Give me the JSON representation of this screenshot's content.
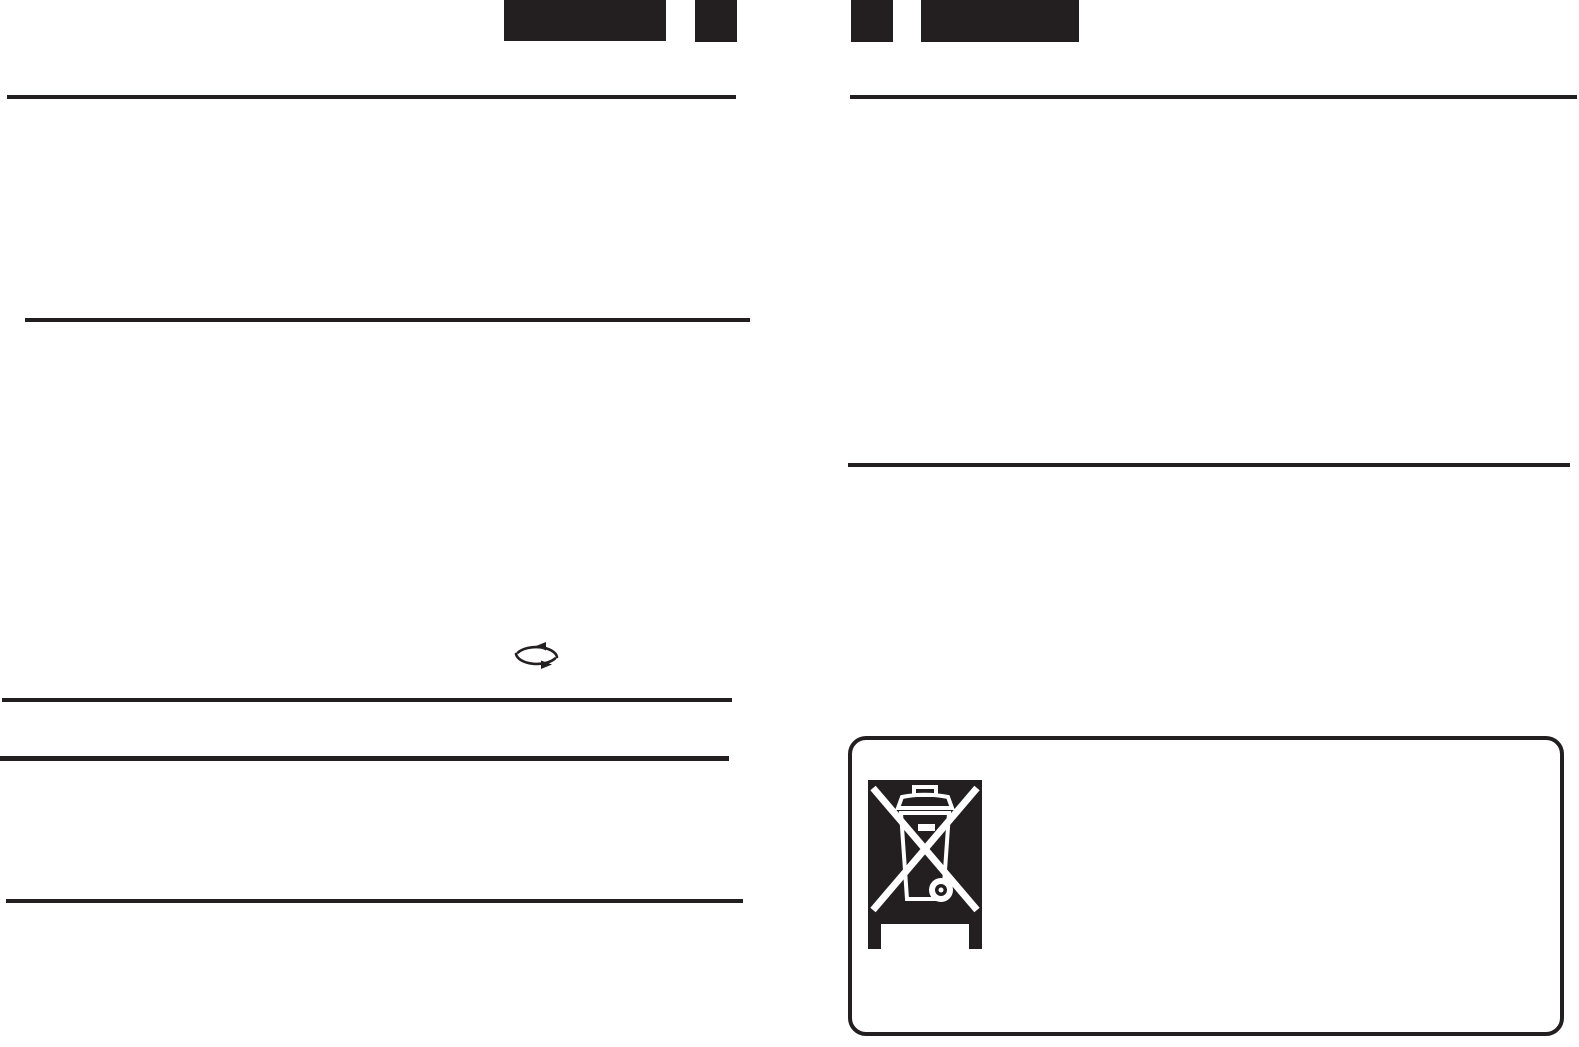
{
  "page": {
    "type": "scanned-manual-page",
    "background_color": "#ffffff",
    "ink_color": "#231f20"
  },
  "header": {
    "redacted_blocks": [
      {
        "name": "redacted-header-block-1",
        "appearance": "solid black rectangle, large"
      },
      {
        "name": "redacted-header-block-2",
        "appearance": "solid black rectangle, small"
      },
      {
        "name": "redacted-header-block-3",
        "appearance": "solid black rectangle, small"
      },
      {
        "name": "redacted-header-block-4",
        "appearance": "solid black rectangle, large"
      }
    ]
  },
  "columns": {
    "left_rules_count": 5,
    "right_rules_count": 2
  },
  "icons": [
    {
      "name": "recycle-arrows-icon",
      "glyph": "two curved cycle arrows forming an ellipse"
    },
    {
      "name": "weee-crossed-bin-icon",
      "glyph": "crossed-out wheeled bin on black square with bar (WEEE disposal symbol)"
    }
  ]
}
